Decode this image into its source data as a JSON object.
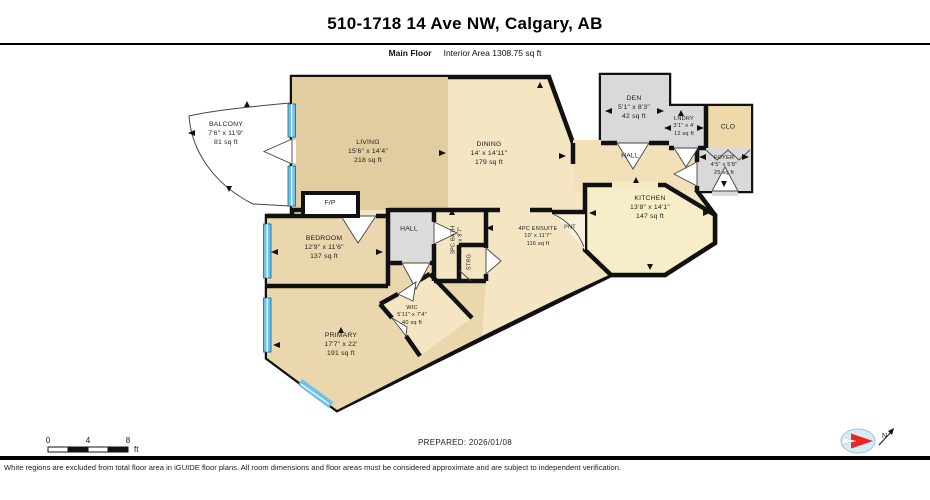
{
  "header": {
    "title": "510-1718 14 Ave NW, Calgary, AB",
    "floor_label": "Main Floor",
    "area_label": "Interior Area 1308.75 sq ft"
  },
  "rooms": {
    "balcony": {
      "name": "BALCONY",
      "dims": "7'6\" x 11'9\"",
      "area": "81 sq ft"
    },
    "living": {
      "name": "LIVING",
      "dims": "15'6\" x 14'4\"",
      "area": "218 sq ft"
    },
    "dining": {
      "name": "DINING",
      "dims": "14' x 14'11\"",
      "area": "179 sq ft"
    },
    "den": {
      "name": "DEN",
      "dims": "5'1\" x 8'3\"",
      "area": "42 sq ft"
    },
    "laundry": {
      "name": "LNDRY",
      "dims": "3'1\" x 4'",
      "area": "12 sq ft"
    },
    "closet": {
      "name": "CLO"
    },
    "foyer": {
      "name": "FOYER",
      "dims": "4'5\" x 5'8\"",
      "area": "25 sq ft"
    },
    "hall_upper": {
      "name": "HALL"
    },
    "kitchen": {
      "name": "KITCHEN",
      "dims": "13'8\" x 14'1\"",
      "area": "147 sq ft"
    },
    "fireplace": {
      "name": "F/P"
    },
    "hall_lower": {
      "name": "HALL"
    },
    "bath": {
      "name": "3PC BATH",
      "dims": "5'1\" x 8'7\""
    },
    "storage": {
      "name": "STRG"
    },
    "bedroom": {
      "name": "BEDROOM",
      "dims": "12'9\" x 11'6\"",
      "area": "137 sq ft"
    },
    "ensuite": {
      "name": "4PC ENSUITE",
      "dims": "10' x 11'7\"",
      "area": "116 sq ft"
    },
    "pantry": {
      "name": "PNT"
    },
    "wic": {
      "name": "WIC",
      "dims": "5'11\" x 7'4\"",
      "area": "40 sq ft"
    },
    "primary": {
      "name": "PRIMARY",
      "dims": "17'7\" x 22'",
      "area": "191 sq ft"
    }
  },
  "scale": {
    "tick0": "0",
    "tick4": "4",
    "tick8": "8",
    "unit": "ft"
  },
  "footer": {
    "prepared": "PREPARED: 2026/01/08",
    "compass_north": "N",
    "disclaimer": "White regions are excluded from total floor area in iGUIDE floor plans. All room dimensions and floor areas must be considered approximate and are subject to independent verification."
  },
  "colors": {
    "wall": "#111111",
    "window_blue": "#6fc2e6",
    "room_tan": "#e2cda0",
    "room_cream": "#f4e5c3",
    "room_gray": "#d9d9d9",
    "kitchen_yellow": "#f7eec9"
  }
}
